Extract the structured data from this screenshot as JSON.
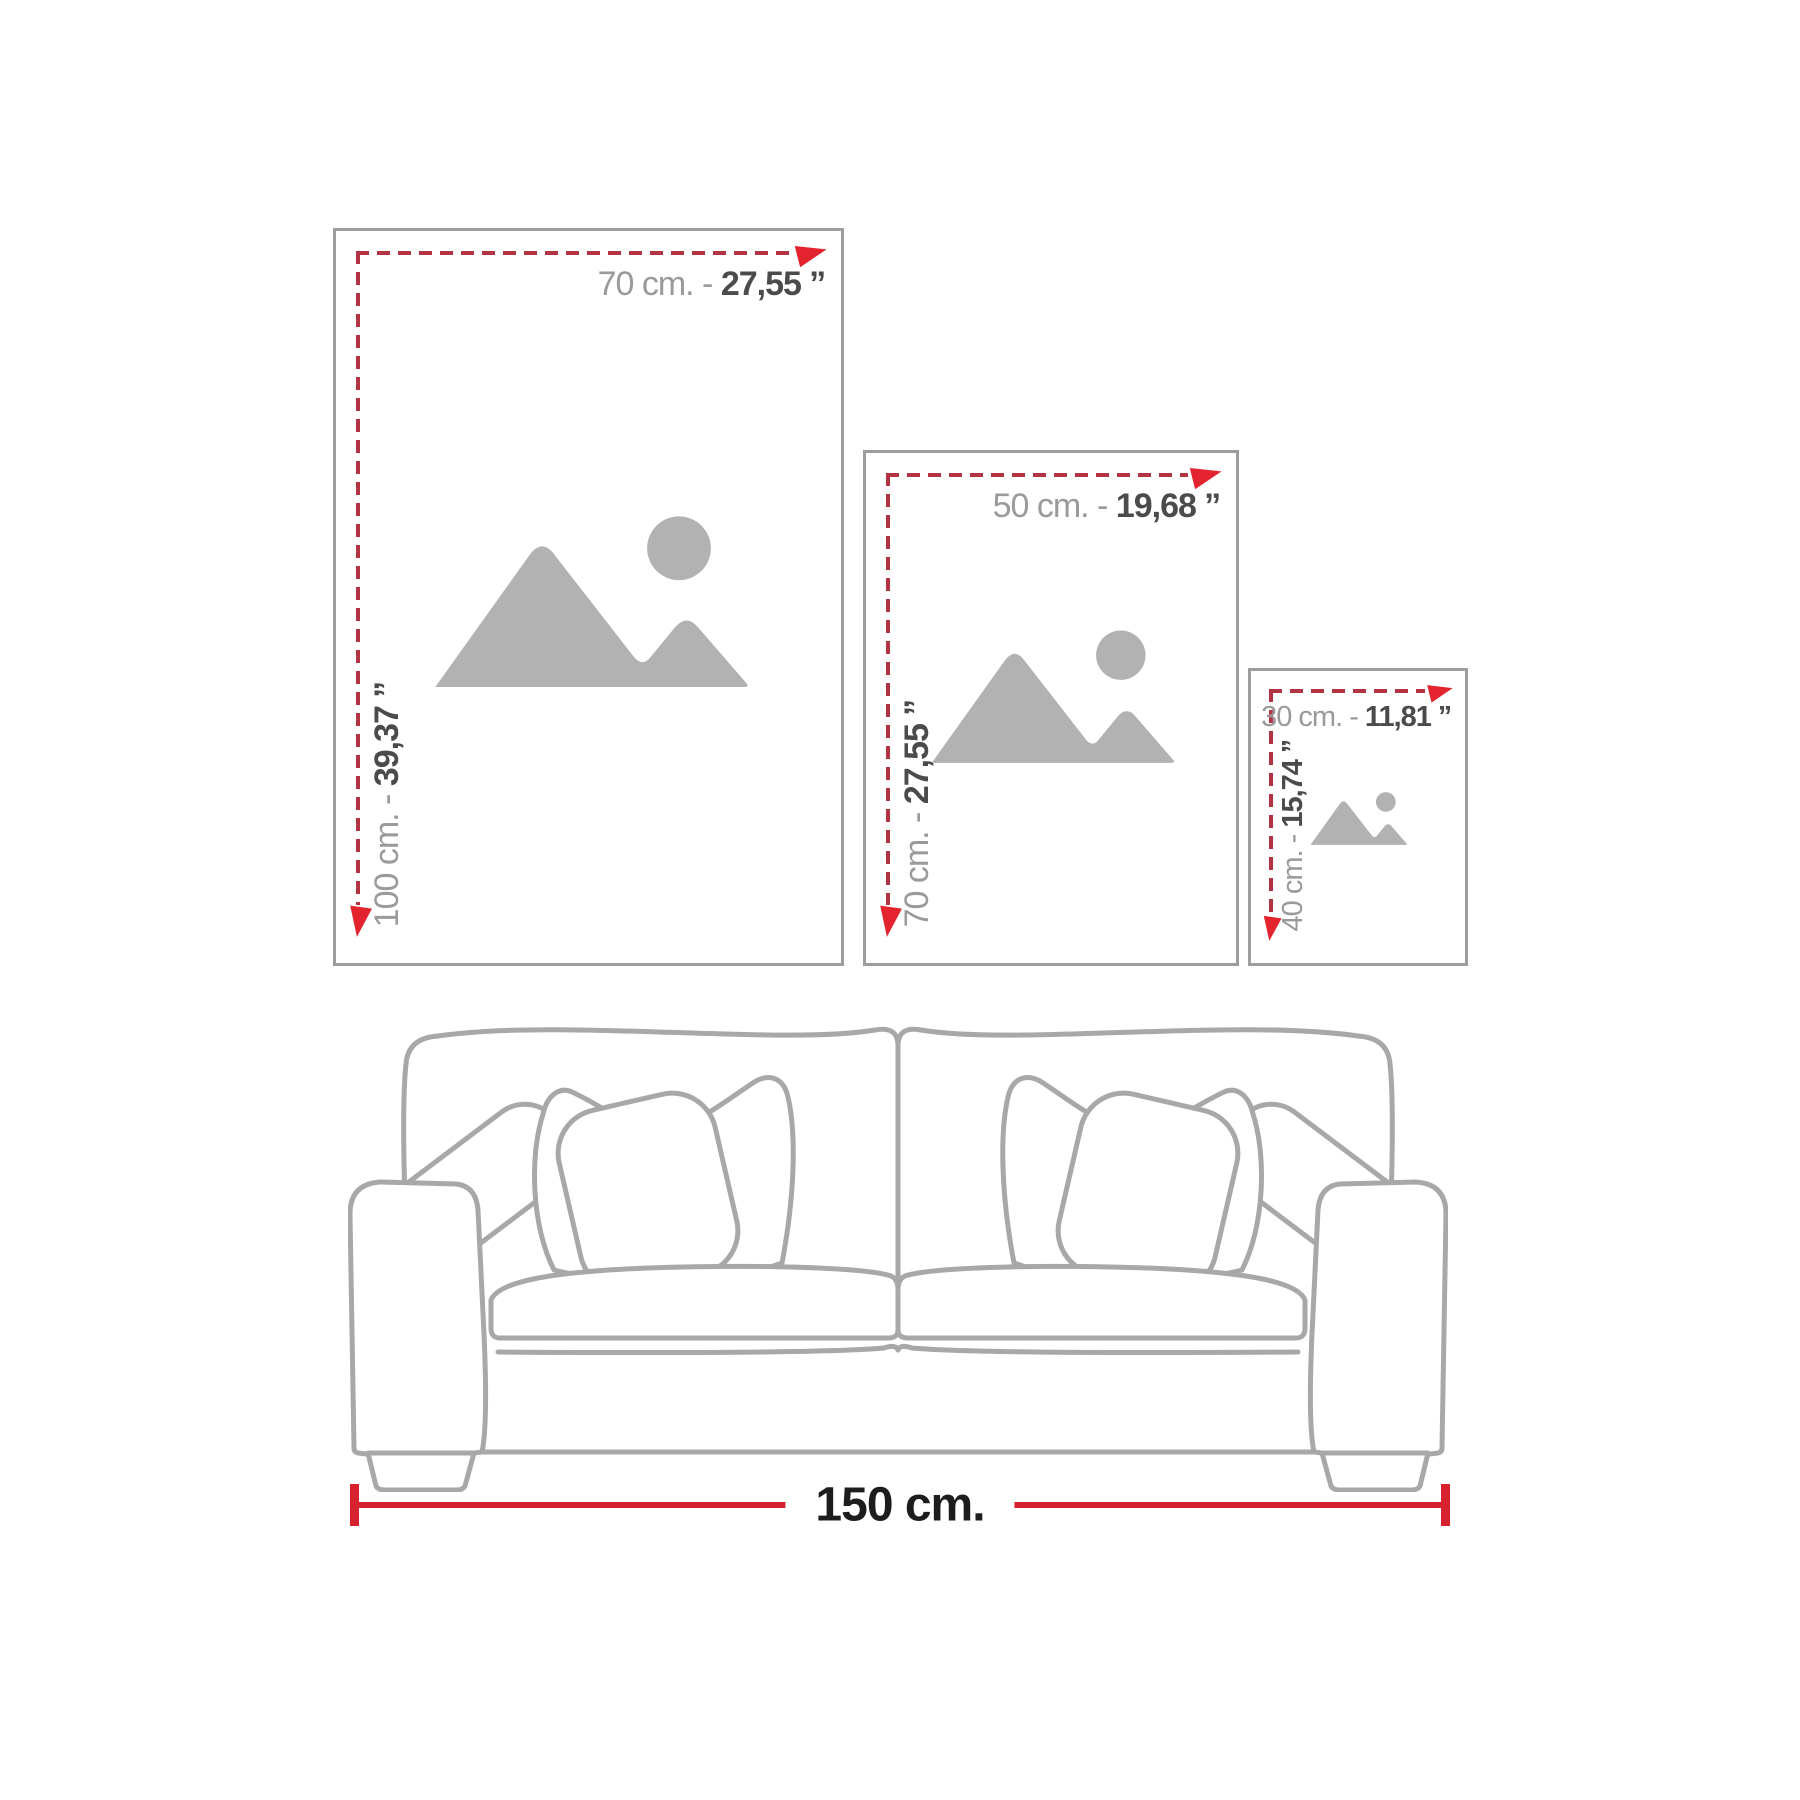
{
  "colors": {
    "frame_border": "#9d9d9d",
    "placeholder_icon": "#b2b2b2",
    "dash_red": "#b23442",
    "arrow_red": "#e3242e",
    "measure_red": "#d6222e",
    "text_gray": "#9a9a9a",
    "text_dark": "#4b4b4b",
    "text_black": "#1d1d1b",
    "sofa_line": "#a8a8a8"
  },
  "frames": [
    {
      "name": "100x70",
      "width_gray": "70 cm. - ",
      "width_dark": "27,55 ’’",
      "height_gray": "100 cm. - ",
      "height_dark": "39,37 ’’"
    },
    {
      "name": "70x50",
      "width_gray": "50 cm. - ",
      "width_dark": "19,68 ’’",
      "height_gray": "70 cm. - ",
      "height_dark": "27,55 ’’"
    },
    {
      "name": "40x30",
      "width_gray": "30 cm. - ",
      "width_dark": "11,81 ’’",
      "height_gray": "40 cm. - ",
      "height_dark": "15,74 ’’"
    }
  ],
  "sofa": {
    "width_label": "150 cm."
  },
  "icons": {
    "placeholder": "mountains-and-sun image placeholder",
    "arrow_right": "red measure arrow pointing right",
    "arrow_down": "red measure arrow pointing down"
  }
}
